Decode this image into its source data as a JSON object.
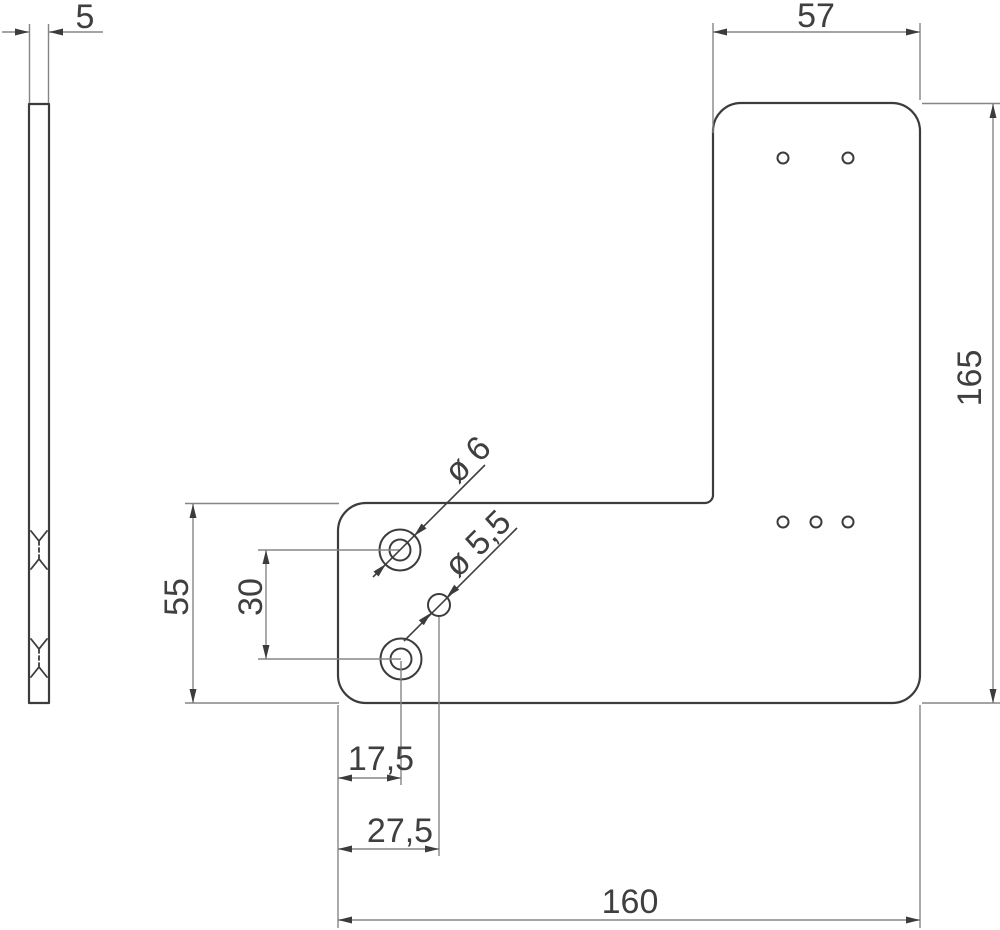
{
  "drawing": {
    "description": "L-shaped flat mounting plate, two-view technical drawing",
    "labels": {
      "thickness": "5",
      "top_width": "57",
      "overall_height": "165",
      "overall_width": "160",
      "lower_section_height": "55",
      "hole_vertical_spacing": "30",
      "counterbore_hole_offset": "17,5",
      "small_hole_offset": "27,5",
      "counterbore_hole_diameter": "ø 6",
      "small_hole_diameter": "ø 5,5"
    },
    "colors": {
      "background": "#ffffff",
      "outline": "#3c3c3c",
      "dimension_lines": "#858585",
      "text": "#3f3f3f"
    }
  }
}
